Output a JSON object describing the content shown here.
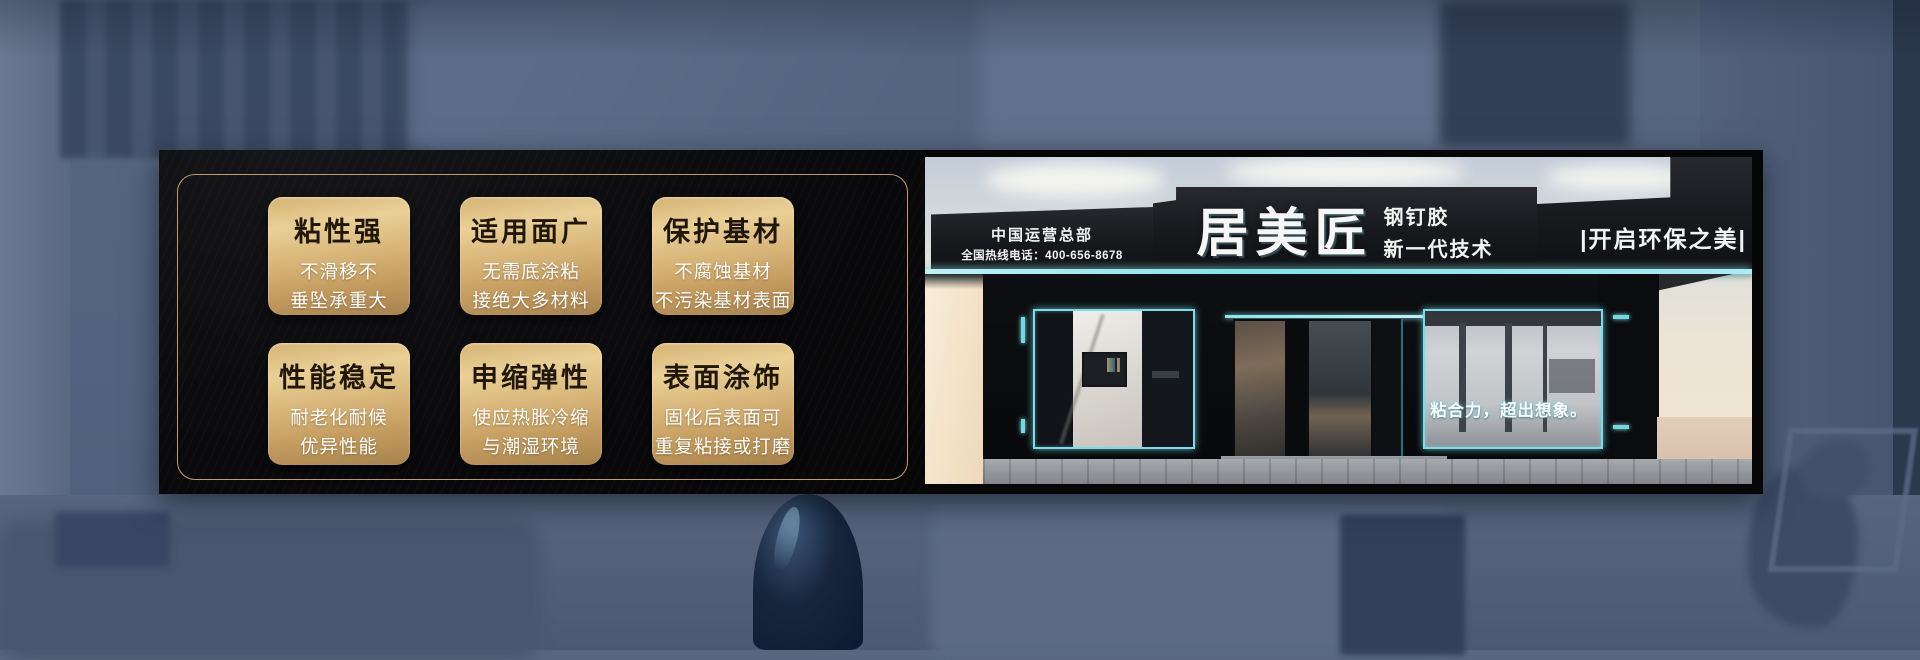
{
  "left_panel": {
    "features": [
      {
        "title": "粘性强",
        "line1": "不滑移不",
        "line2": "垂坠承重大"
      },
      {
        "title": "适用面广",
        "line1": "无需底涂粘",
        "line2": "接绝大多材料"
      },
      {
        "title": "保护基材",
        "line1": "不腐蚀基材",
        "line2": "不污染基材表面"
      },
      {
        "title": "性能稳定",
        "line1": "耐老化耐候",
        "line2": "优异性能"
      },
      {
        "title": "申缩弹性",
        "line1": "使应热胀冷缩",
        "line2": "与潮湿环境"
      },
      {
        "title": "表面涂饰",
        "line1": "固化后表面可",
        "line2": "重复粘接或打磨"
      }
    ]
  },
  "storefront": {
    "hq_label": "中国运营总部",
    "hotline_label": "全国热线电话：400-656-8678",
    "brand": "居美匠",
    "product_label": "钢钉胶",
    "tech_label": "新一代技术",
    "slogan_right": "|开启环保之美|",
    "window_slogan": "粘合力，超出想象。"
  },
  "colors": {
    "banner_black": "#060607",
    "gold_border": "#bf9c6b",
    "card_gold_light": "#e9d096",
    "card_gold_dark": "#a6824b",
    "card_title_text": "#201708",
    "card_detail_text": "#ffffff",
    "neon_cyan": "#7ee3ea",
    "signboard_dark": "#17191d",
    "background_blue": "#53627e"
  }
}
